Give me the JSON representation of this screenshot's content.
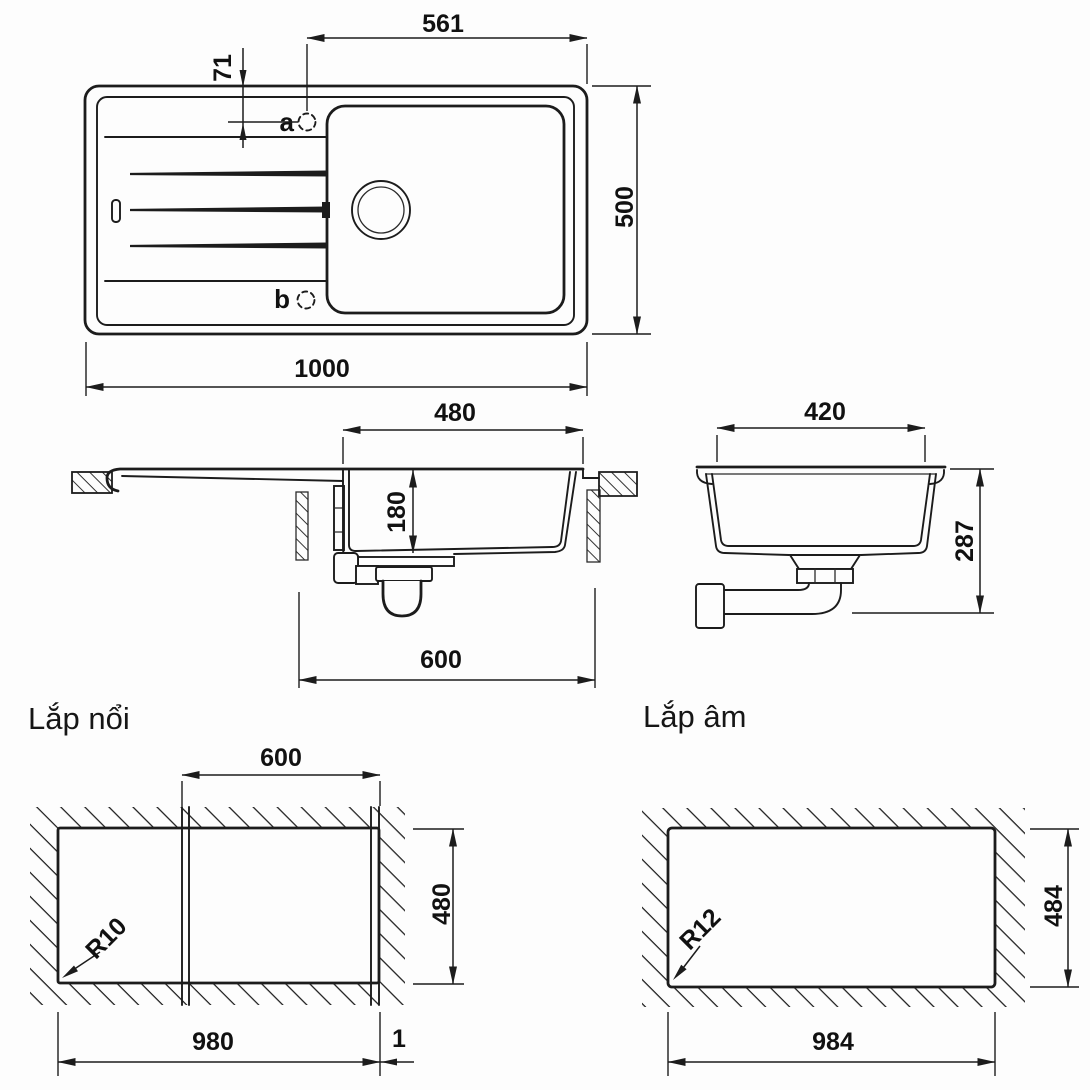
{
  "drawing": {
    "description": "Kitchen sink installation technical drawing",
    "ink_color": "#1c1c1c",
    "background_color": "#fdfdfd"
  },
  "top_view": {
    "dim_hole_offset_right": "561",
    "dim_hole_offset_top": "71",
    "dim_overall_depth": "500",
    "dim_overall_width": "1000",
    "hole_a_label": "a",
    "hole_b_label": "b"
  },
  "side_view": {
    "dim_bowl_top_width": "480",
    "dim_bowl_depth": "180",
    "dim_base_width": "600"
  },
  "end_view": {
    "dim_bowl_width": "420",
    "dim_total_height": "287"
  },
  "surface_mount": {
    "title": "Lắp nổi",
    "dim_cabinet_width": "600",
    "dim_cutout_depth": "480",
    "dim_cutout_width": "980",
    "dim_edge_gap": "1",
    "corner_radius": "R10"
  },
  "flush_mount": {
    "title": "Lắp âm",
    "dim_cutout_depth": "484",
    "dim_cutout_width": "984",
    "corner_radius": "R12"
  }
}
